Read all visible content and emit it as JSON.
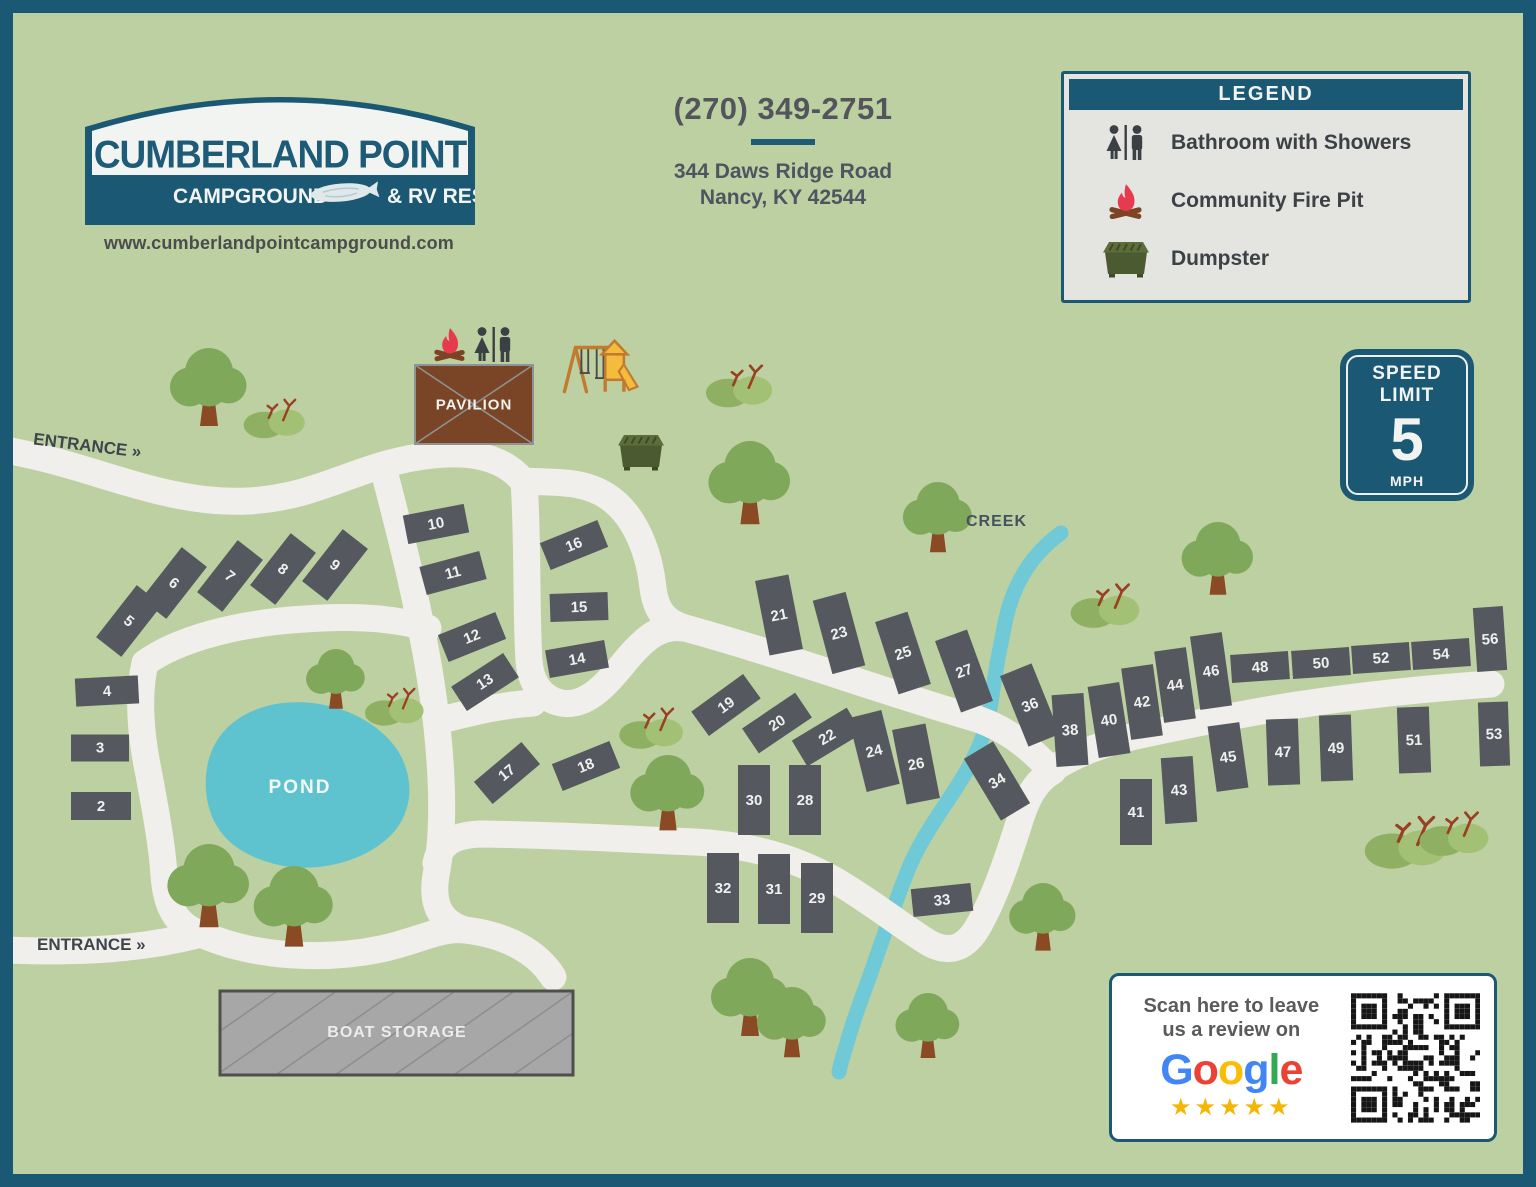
{
  "header": {
    "logo": {
      "title": "CUMBERLAND POINT",
      "band_left": "CAMPGROUND",
      "band_right": "& RV RESORT",
      "website": "www.cumberlandpointcampground.com"
    },
    "contact": {
      "phone": "(270) 349-2751",
      "address_line1": "344 Daws Ridge Road",
      "address_line2": "Nancy, KY 42544"
    }
  },
  "legend": {
    "title": "LEGEND",
    "items": [
      {
        "icon": "restroom-icon",
        "label": "Bathroom with Showers"
      },
      {
        "icon": "firepit-icon",
        "label": "Community Fire Pit"
      },
      {
        "icon": "dumpster-icon",
        "label": "Dumpster"
      }
    ]
  },
  "speed_sign": {
    "line1": "SPEED",
    "line2": "LIMIT",
    "value": "5",
    "unit": "MPH"
  },
  "map": {
    "labels": {
      "entrance_top": "ENTRANCE »",
      "entrance_bottom": "ENTRANCE »",
      "pond": "POND",
      "creek": "CREEK",
      "pavilion": "PAVILION",
      "boat_storage": "BOAT STORAGE"
    },
    "sites": [
      {
        "n": "2",
        "x": 88,
        "y": 793,
        "w": 60,
        "h": 28,
        "r": 0
      },
      {
        "n": "3",
        "x": 87,
        "y": 735,
        "w": 58,
        "h": 27,
        "r": 0
      },
      {
        "n": "4",
        "x": 94,
        "y": 678,
        "w": 63,
        "h": 28,
        "r": -3
      },
      {
        "n": "5",
        "x": 116,
        "y": 608,
        "w": 32,
        "h": 66,
        "r": 38
      },
      {
        "n": "6",
        "x": 161,
        "y": 570,
        "w": 32,
        "h": 66,
        "r": 38
      },
      {
        "n": "7",
        "x": 217,
        "y": 563,
        "w": 32,
        "h": 66,
        "r": 38
      },
      {
        "n": "8",
        "x": 270,
        "y": 556,
        "w": 32,
        "h": 66,
        "r": 38
      },
      {
        "n": "9",
        "x": 322,
        "y": 552,
        "w": 32,
        "h": 66,
        "r": 38
      },
      {
        "n": "10",
        "x": 423,
        "y": 511,
        "w": 62,
        "h": 29,
        "r": -11
      },
      {
        "n": "11",
        "x": 440,
        "y": 560,
        "w": 62,
        "h": 29,
        "r": -15
      },
      {
        "n": "12",
        "x": 459,
        "y": 624,
        "w": 62,
        "h": 29,
        "r": -22
      },
      {
        "n": "13",
        "x": 472,
        "y": 669,
        "w": 62,
        "h": 29,
        "r": -33
      },
      {
        "n": "14",
        "x": 564,
        "y": 646,
        "w": 60,
        "h": 28,
        "r": -10
      },
      {
        "n": "15",
        "x": 566,
        "y": 594,
        "w": 58,
        "h": 28,
        "r": -2
      },
      {
        "n": "16",
        "x": 561,
        "y": 532,
        "w": 62,
        "h": 29,
        "r": -22
      },
      {
        "n": "17",
        "x": 494,
        "y": 760,
        "w": 62,
        "h": 29,
        "r": -40
      },
      {
        "n": "18",
        "x": 573,
        "y": 753,
        "w": 62,
        "h": 29,
        "r": -22
      },
      {
        "n": "19",
        "x": 713,
        "y": 692,
        "w": 64,
        "h": 30,
        "r": -36
      },
      {
        "n": "20",
        "x": 764,
        "y": 710,
        "w": 64,
        "h": 30,
        "r": -34
      },
      {
        "n": "21",
        "x": 766,
        "y": 602,
        "w": 34,
        "h": 76,
        "r": -11
      },
      {
        "n": "22",
        "x": 814,
        "y": 724,
        "w": 64,
        "h": 30,
        "r": -31
      },
      {
        "n": "23",
        "x": 826,
        "y": 620,
        "w": 34,
        "h": 76,
        "r": -15
      },
      {
        "n": "24",
        "x": 861,
        "y": 738,
        "w": 34,
        "h": 76,
        "r": -14
      },
      {
        "n": "25",
        "x": 890,
        "y": 640,
        "w": 34,
        "h": 76,
        "r": -18
      },
      {
        "n": "26",
        "x": 903,
        "y": 751,
        "w": 34,
        "h": 76,
        "r": -11
      },
      {
        "n": "27",
        "x": 951,
        "y": 658,
        "w": 34,
        "h": 76,
        "r": -20
      },
      {
        "n": "28",
        "x": 792,
        "y": 787,
        "w": 32,
        "h": 70,
        "r": 0
      },
      {
        "n": "29",
        "x": 804,
        "y": 885,
        "w": 32,
        "h": 70,
        "r": 0
      },
      {
        "n": "30",
        "x": 741,
        "y": 787,
        "w": 32,
        "h": 70,
        "r": 0
      },
      {
        "n": "31",
        "x": 761,
        "y": 876,
        "w": 32,
        "h": 70,
        "r": 0
      },
      {
        "n": "32",
        "x": 710,
        "y": 875,
        "w": 32,
        "h": 70,
        "r": 0
      },
      {
        "n": "33",
        "x": 929,
        "y": 887,
        "w": 60,
        "h": 28,
        "r": -6
      },
      {
        "n": "34",
        "x": 984,
        "y": 768,
        "w": 34,
        "h": 72,
        "r": -31
      },
      {
        "n": "36",
        "x": 1017,
        "y": 692,
        "w": 34,
        "h": 76,
        "r": -22
      },
      {
        "n": "38",
        "x": 1057,
        "y": 717,
        "w": 32,
        "h": 72,
        "r": -4
      },
      {
        "n": "40",
        "x": 1096,
        "y": 707,
        "w": 32,
        "h": 72,
        "r": -9
      },
      {
        "n": "41",
        "x": 1123,
        "y": 799,
        "w": 32,
        "h": 66,
        "r": 0
      },
      {
        "n": "42",
        "x": 1129,
        "y": 689,
        "w": 32,
        "h": 72,
        "r": -8
      },
      {
        "n": "43",
        "x": 1166,
        "y": 777,
        "w": 32,
        "h": 66,
        "r": -4
      },
      {
        "n": "44",
        "x": 1162,
        "y": 672,
        "w": 32,
        "h": 72,
        "r": -8
      },
      {
        "n": "45",
        "x": 1215,
        "y": 744,
        "w": 32,
        "h": 66,
        "r": -8
      },
      {
        "n": "46",
        "x": 1198,
        "y": 658,
        "w": 32,
        "h": 74,
        "r": -8
      },
      {
        "n": "47",
        "x": 1270,
        "y": 739,
        "w": 32,
        "h": 66,
        "r": -2
      },
      {
        "n": "48",
        "x": 1247,
        "y": 654,
        "w": 58,
        "h": 28,
        "r": -4
      },
      {
        "n": "49",
        "x": 1323,
        "y": 735,
        "w": 32,
        "h": 66,
        "r": -2
      },
      {
        "n": "50",
        "x": 1308,
        "y": 650,
        "w": 58,
        "h": 28,
        "r": -4
      },
      {
        "n": "51",
        "x": 1401,
        "y": 727,
        "w": 32,
        "h": 66,
        "r": -2
      },
      {
        "n": "52",
        "x": 1368,
        "y": 645,
        "w": 58,
        "h": 28,
        "r": -4
      },
      {
        "n": "53",
        "x": 1481,
        "y": 721,
        "w": 30,
        "h": 64,
        "r": -2
      },
      {
        "n": "54",
        "x": 1428,
        "y": 641,
        "w": 58,
        "h": 28,
        "r": -4
      },
      {
        "n": "56",
        "x": 1477,
        "y": 626,
        "w": 30,
        "h": 64,
        "r": -4
      }
    ]
  },
  "review_box": {
    "line1": "Scan here to leave",
    "line2": "us a review on",
    "brand_letters": [
      {
        "ch": "G",
        "color": "#4285F4"
      },
      {
        "ch": "o",
        "color": "#EA4335"
      },
      {
        "ch": "o",
        "color": "#FBBC05"
      },
      {
        "ch": "g",
        "color": "#4285F4"
      },
      {
        "ch": "l",
        "color": "#34A853"
      },
      {
        "ch": "e",
        "color": "#EA4335"
      }
    ],
    "stars": "★★★★★"
  },
  "colors": {
    "frame_teal": "#1b5874",
    "map_background": "#bdd0a1",
    "road": "#f0efeb",
    "water": "#5fc3cf",
    "site_gray": "#55585e",
    "tree_green": "#7fa85a",
    "bush_green": "#a3c175",
    "pavilion_brown": "#7a4526",
    "star_gold": "#f4b503"
  }
}
